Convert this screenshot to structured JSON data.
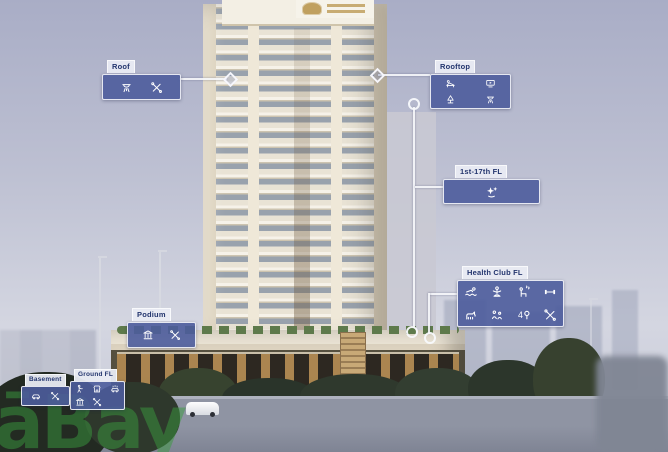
{
  "callouts": {
    "roof": {
      "label": "Roof",
      "icons": [
        "bbq",
        "tools"
      ]
    },
    "rooftop": {
      "label": "Rooftop",
      "icons": [
        "lounge",
        "cinema",
        "garden",
        "bbq"
      ]
    },
    "floors_1_17": {
      "label": "1st-17th FL",
      "icons": [
        "sparkle"
      ]
    },
    "health_club": {
      "label": "Health Club FL",
      "icons": [
        "pool",
        "yoga",
        "sauna",
        "gym",
        "pet",
        "kids",
        "padel-4",
        "tools"
      ]
    },
    "podium": {
      "label": "Podium",
      "icons": [
        "columns",
        "tools"
      ]
    },
    "ground": {
      "label": "Ground FL",
      "icons": [
        "lobby",
        "retail",
        "carwash",
        "columns",
        "tools"
      ]
    },
    "basement": {
      "label": "Basement",
      "icons": [
        "car",
        "tools"
      ]
    }
  },
  "watermark": {
    "text": "āBay",
    "color": "#3a9a3e"
  },
  "colors": {
    "callout_box": "#4c5c9c",
    "callout_border": "#ffffff",
    "callout_tab_bg": "#e9ebf3",
    "callout_tab_text": "#23356e",
    "icon": "#ffffff",
    "sky_top": "#a9adc6",
    "sky_bottom": "#d4d6e1"
  }
}
